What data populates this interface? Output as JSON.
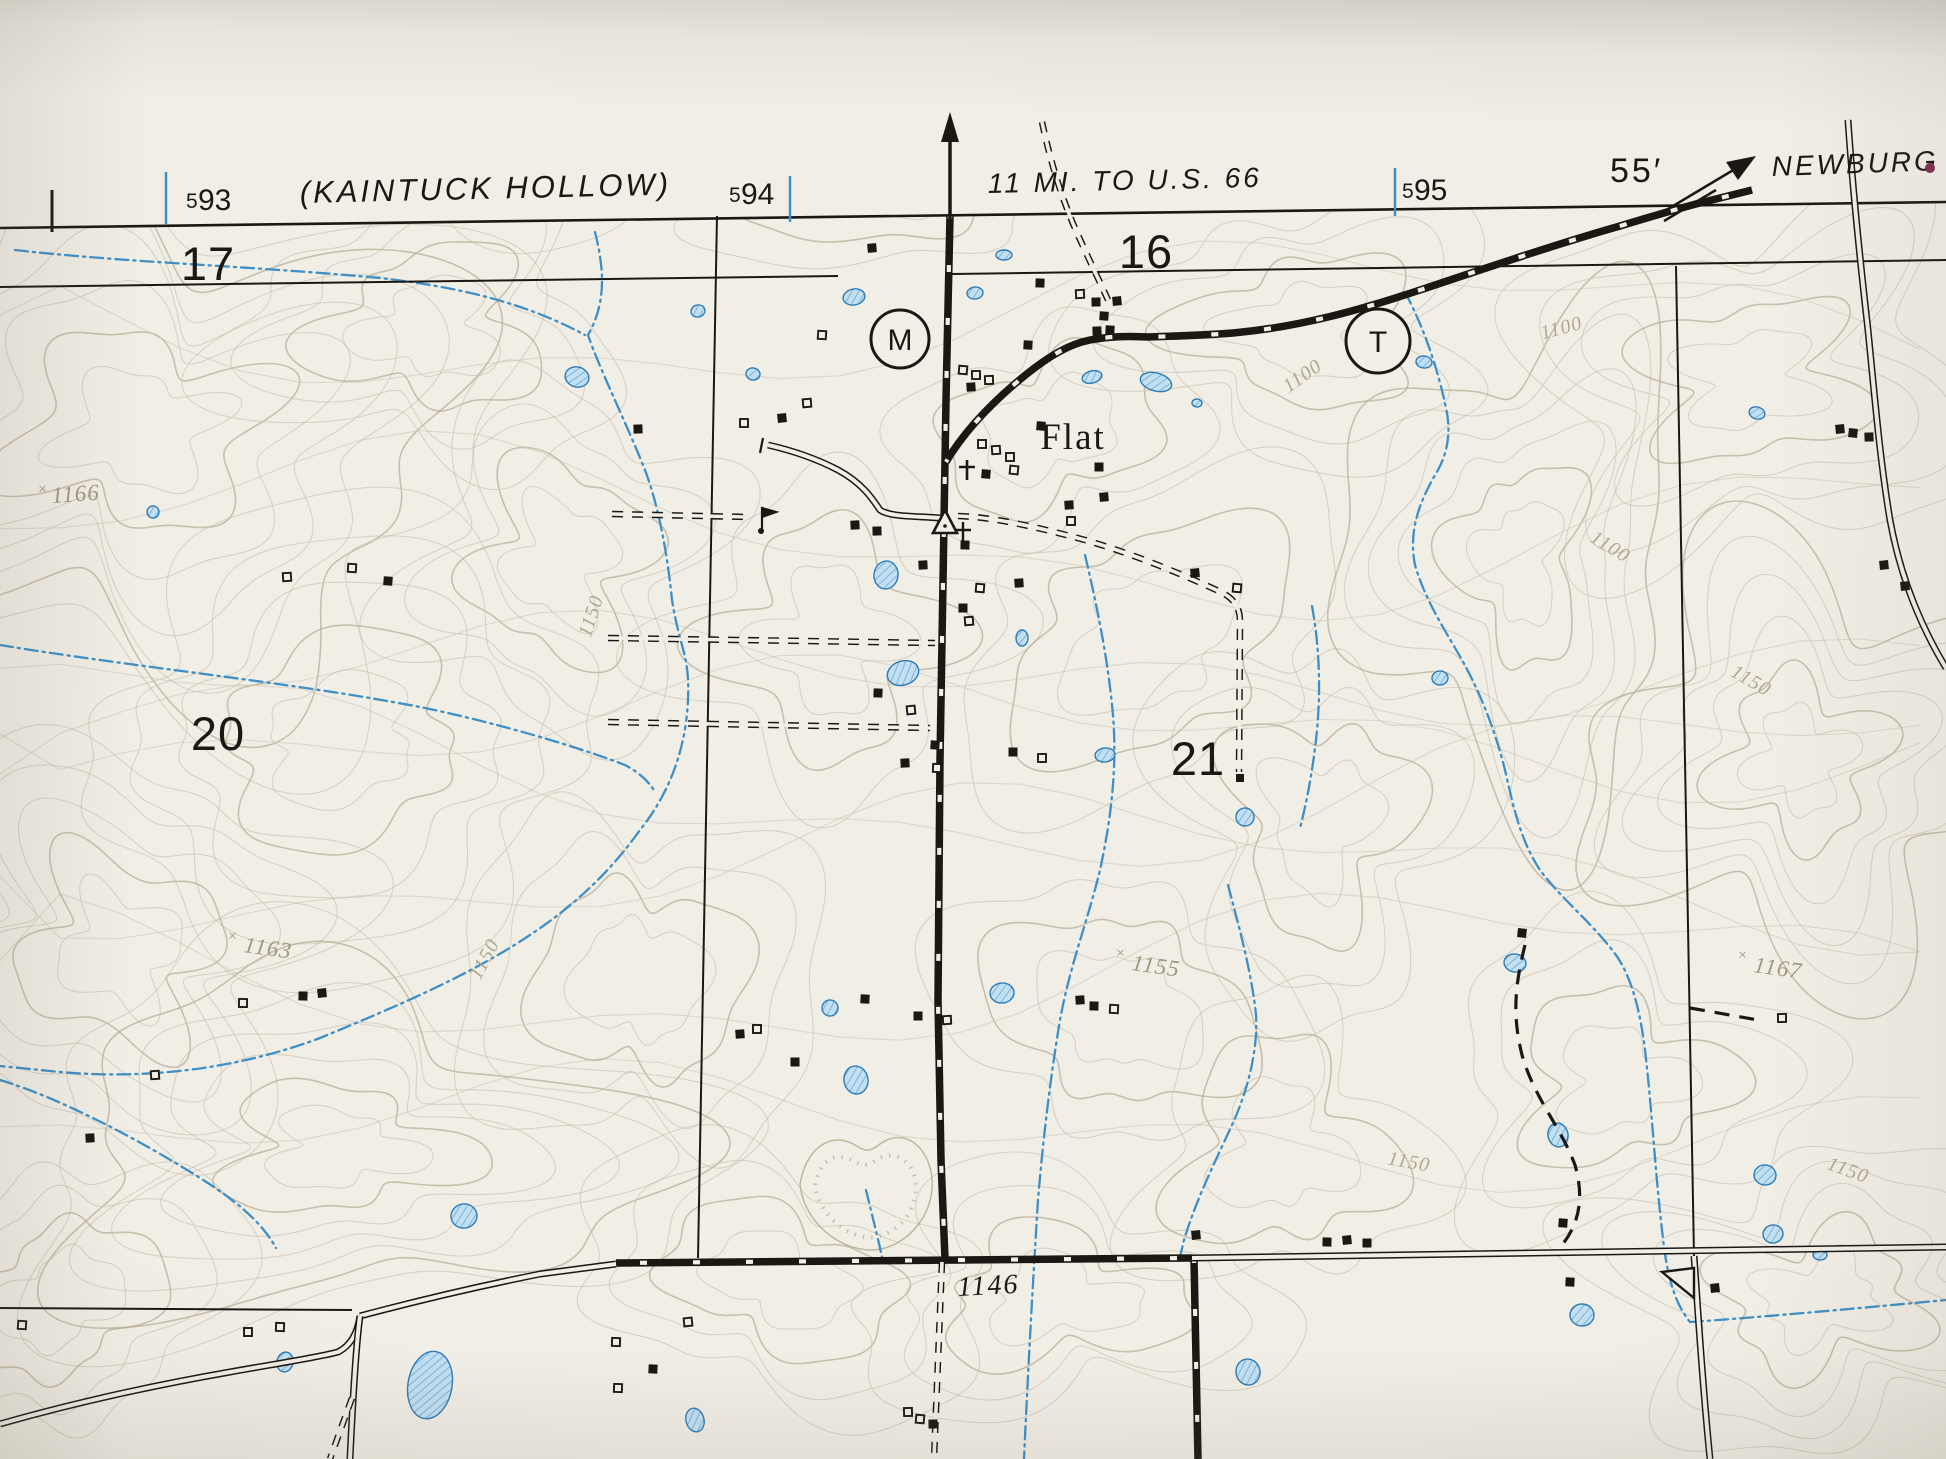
{
  "map": {
    "margin": {
      "left_destination": "(KAINTUCK HOLLOW)",
      "top_destination": "11 MI. TO U.S. 66",
      "right_destination": "NEWBURG",
      "minute_label": "55′",
      "ticks": {
        "t593": {
          "prefix": "5",
          "num": "93"
        },
        "t594": {
          "prefix": "5",
          "num": "94"
        },
        "t595": {
          "prefix": "5",
          "num": "95"
        }
      }
    },
    "sections": {
      "s17": "17",
      "s16": "16",
      "s20": "20",
      "s21": "21"
    },
    "places": {
      "town": "Flat"
    },
    "route_markers": {
      "m": "M",
      "t": "T"
    },
    "spot_elevations": {
      "x_prefix": "×",
      "e1166": "1166",
      "e1163": "1163",
      "e1155": "1155",
      "e1167": "1167",
      "e1146": "1146"
    },
    "contour_labels": {
      "c1100": "1100",
      "c1150": "1150"
    },
    "colors": {
      "paper": "#f1eee6",
      "ink_black": "#1b1713",
      "contour": "#c8c0af",
      "index_contour": "#b7ab93",
      "water_blue": "#3e8fc7",
      "pond_fill": "#c2e0f2",
      "label_gray": "#a1977e",
      "newburg_dot": "#7e2d52"
    }
  }
}
